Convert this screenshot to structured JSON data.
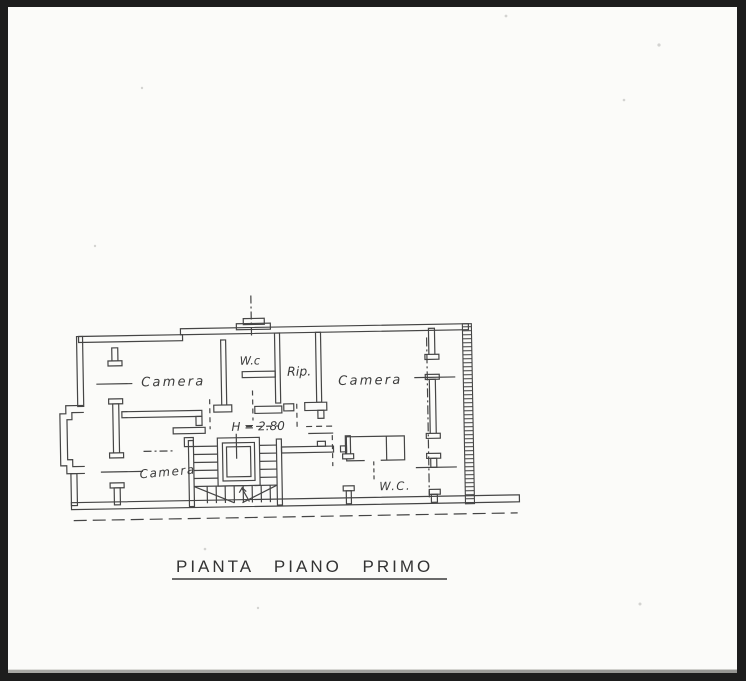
{
  "document": {
    "title": "PIANTA PIANO PRIMO"
  },
  "floor_plan": {
    "rooms": [
      {
        "id": "camera-top-left",
        "label": "Camera"
      },
      {
        "id": "wc-top",
        "label": "W.c"
      },
      {
        "id": "ripostiglio-top",
        "label": "Rip."
      },
      {
        "id": "camera-top-right",
        "label": "Camera"
      },
      {
        "id": "camera-bottom-left",
        "label": "Camera"
      },
      {
        "id": "wc-bottom-right",
        "label": "W.C."
      }
    ],
    "annotations": {
      "ceiling_height": "H = 2.80"
    },
    "colors": {
      "paper": "#fbfbf9",
      "ink": "#454545",
      "scanner_border": "#1d1d1d"
    }
  }
}
